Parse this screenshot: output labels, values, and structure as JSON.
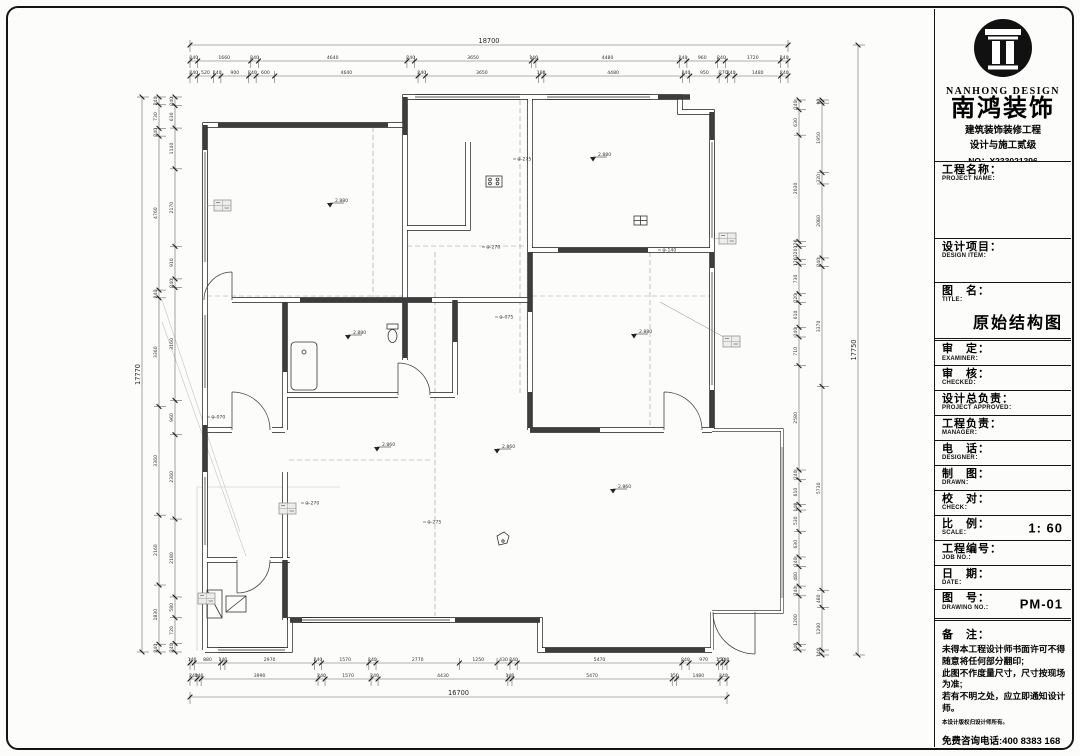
{
  "title_block": {
    "brand": {
      "logo_en": "NANHONG DESIGN",
      "logo_cn": "南鸿装饰",
      "line1": "建筑装饰装修工程",
      "line2": "设计与施工贰级",
      "no": "NO：X233021396"
    },
    "fields": [
      {
        "cn": "工程名称：",
        "en": "PROJECT NAME：",
        "value": ""
      },
      {
        "cn": "设计项目：",
        "en": "DESIGN ITEM：",
        "value": ""
      },
      {
        "cn": "图　名：",
        "en": "TITLE：",
        "value": "原始结构图"
      },
      {
        "cn": "审　定：",
        "en": "EXAMINER：",
        "value": ""
      },
      {
        "cn": "审　核：",
        "en": "CHECKED：",
        "value": ""
      },
      {
        "cn": "设计总负责：",
        "en": "PROJECT APPROVED：",
        "value": ""
      },
      {
        "cn": "工程负责：",
        "en": "MANAGER：",
        "value": ""
      },
      {
        "cn": "电　话：",
        "en": "DESIGNER：",
        "value": ""
      },
      {
        "cn": "制　图：",
        "en": "DRAWN：",
        "value": ""
      },
      {
        "cn": "校　对：",
        "en": "CHECK：",
        "value": ""
      },
      {
        "cn": "比　例：",
        "en": "SCALE：",
        "value": "1: 60"
      },
      {
        "cn": "工程编号：",
        "en": "JOB NO.：",
        "value": ""
      },
      {
        "cn": "日　期：",
        "en": "DATE：",
        "value": ""
      },
      {
        "cn": "图　号：",
        "en": "DRAWING NO.：",
        "value": "PM-01"
      }
    ],
    "notes": {
      "label": "备　注：",
      "lines": [
        "未得本工程设计师书面许可不得随意将任何部分翻印;",
        "此图不作度量尺寸，尺寸按现场为准;",
        "若有不明之处，应立即通知设计师。"
      ],
      "fine_print": "本设计版权归设计师所有。",
      "hotline": "免费咨询电话:400 8383 168"
    }
  },
  "drawing": {
    "dims": {
      "top": {
        "total": "18700",
        "chain2": [
          "240",
          "1660",
          "240",
          "4640",
          "240",
          "3650",
          "140",
          "4480",
          "240",
          "960",
          "240",
          "1720",
          "240"
        ],
        "chain3": [
          "240",
          "520",
          "240",
          "900",
          "240",
          "600",
          "4640",
          "240",
          "3650",
          "180",
          "4480",
          "240",
          "950",
          "270",
          "240",
          "1480",
          "240"
        ]
      },
      "bottom": {
        "total": "16700",
        "chain1": [
          "140",
          "880",
          "140",
          "2970",
          "240",
          "1570",
          "240",
          "2770",
          "1250",
          "430",
          "240",
          "5470",
          "240",
          "970",
          "150",
          "140"
        ],
        "chain2": [
          "240",
          "140",
          "3990",
          "240",
          "1570",
          "240",
          "4430",
          "140",
          "5470",
          "150",
          "1480",
          "240"
        ]
      },
      "left": {
        "total": "17770",
        "chain2": [
          "240",
          "730",
          "240",
          "4760",
          "240",
          "3360",
          "3360",
          "2160",
          "1830",
          "240"
        ],
        "chain3": [
          "240",
          "630",
          "1140",
          "2170",
          "910",
          "240",
          "3160",
          "960",
          "2360",
          "2180",
          "580",
          "720",
          "240"
        ]
      },
      "right": {
        "total": "17750",
        "chain1": [
          "240",
          "630",
          "2630",
          "120",
          "320",
          "120",
          "730",
          "220",
          "610",
          "240",
          "710",
          "2580",
          "240",
          "610",
          "140",
          "530",
          "630",
          "240",
          "480",
          "240",
          "1200",
          "140"
        ],
        "chain2": [
          "90",
          "1950",
          "320",
          "2080",
          "240",
          "3370",
          "5730",
          "480",
          "1200",
          "140"
        ]
      }
    },
    "markers": {
      "elevations": [
        {
          "x": 327,
          "y": 203,
          "t": "2.880"
        },
        {
          "x": 590,
          "y": 157,
          "t": "2.880"
        },
        {
          "x": 345,
          "y": 335,
          "t": "2.880"
        },
        {
          "x": 631,
          "y": 334,
          "t": "2.880"
        },
        {
          "x": 374,
          "y": 447,
          "t": "2.860"
        },
        {
          "x": 494,
          "y": 449,
          "t": "2.860"
        },
        {
          "x": 610,
          "y": 489,
          "t": "2.860"
        }
      ],
      "beams": [
        {
          "x": 517,
          "y": 159,
          "t": "⊕-275"
        },
        {
          "x": 486,
          "y": 247,
          "t": "⊕-270"
        },
        {
          "x": 499,
          "y": 317,
          "t": "⊕-075"
        },
        {
          "x": 662,
          "y": 250,
          "t": "⊕-140"
        },
        {
          "x": 305,
          "y": 503,
          "t": "⊕-270"
        },
        {
          "x": 427,
          "y": 522,
          "t": "⊕-275"
        },
        {
          "x": 211,
          "y": 417,
          "t": "⊕-070"
        }
      ],
      "window_tags": [
        {
          "x": 214,
          "y": 200,
          "lx": 207,
          "ly": 206
        },
        {
          "x": 719,
          "y": 233,
          "lx": 713,
          "ly": 239
        },
        {
          "x": 723,
          "y": 336,
          "lx": 660,
          "ly": 302
        },
        {
          "x": 279,
          "y": 503,
          "lx": 286,
          "ly": 509
        },
        {
          "x": 198,
          "y": 593,
          "lx": 206,
          "ly": 599
        }
      ]
    }
  }
}
